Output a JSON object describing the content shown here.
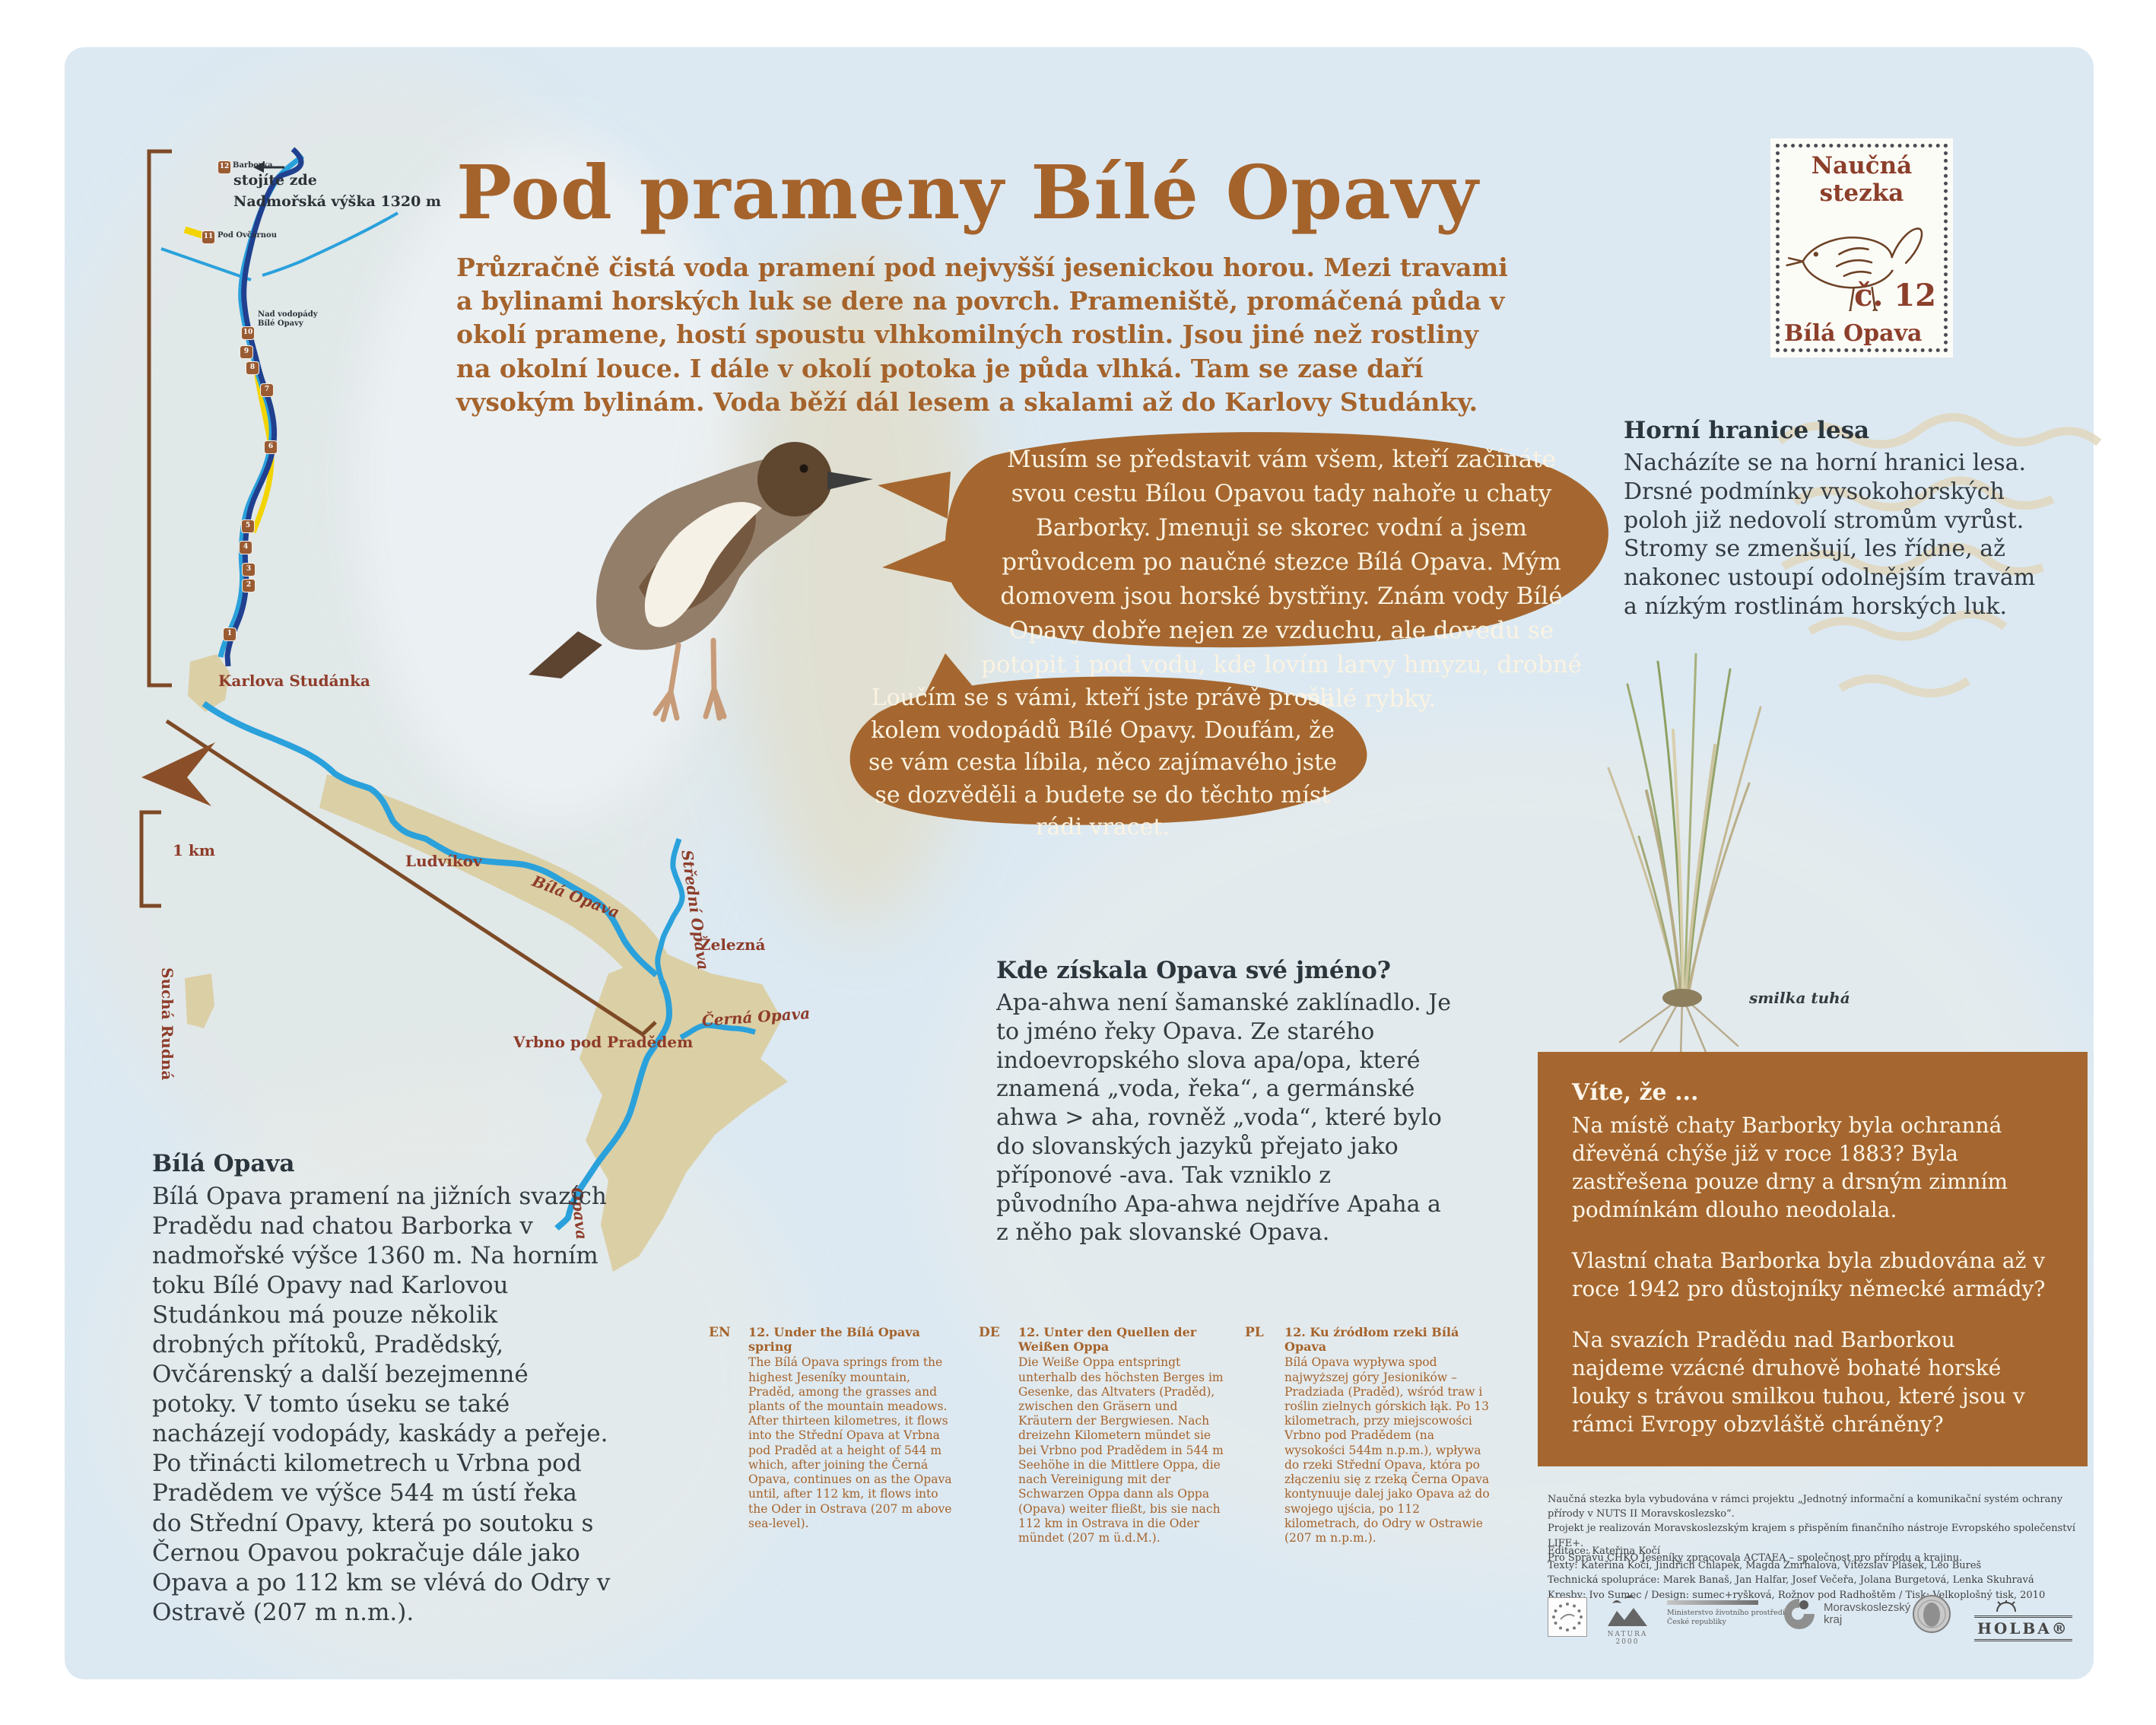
{
  "header": {
    "title": "Pod prameny Bílé Opavy",
    "intro": "Průzračně čistá voda pramení pod nejvyšší jesenickou horou. Mezi travami a bylinami horských luk se dere na povrch. Prameniště, promáčená půda v okolí pramene, hostí spoustu vlhkomilných rostlin. Jsou jiné než rostliny na okolní louce. I dále v okolí potoka je půda vlhká. Tam se zase daří vysokým bylinám. Voda běží dál lesem a skalami až do Karlovy Studánky."
  },
  "stamp": {
    "top": "Naučná stezka",
    "number": "č. 12",
    "bottom": "Bílá Opava"
  },
  "map": {
    "you_are_here": "stojíte zde",
    "altitude": "Nadmořská výška 1320 m",
    "scale": "1 km",
    "station_12": "Barborka",
    "station_11": "Pod Ovčárnou",
    "station_10": "Nad vodopády Bílé Opavy",
    "places": {
      "karlova_studanka": "Karlova Studánka",
      "ludvikov": "Ludvíkov",
      "vrbno": "Vrbno pod Pradědem",
      "zelezna": "Železná",
      "sucha_rudna": "Suchá Rudná"
    },
    "rivers": {
      "bila": "Bílá Opava",
      "stredni": "Střední Opava",
      "cerna": "Černá Opava",
      "opava": "Opava"
    },
    "markers": [
      "1",
      "2",
      "3",
      "4",
      "5",
      "6",
      "7",
      "8",
      "9",
      "10",
      "11",
      "12"
    ]
  },
  "bubbles": {
    "intro": "Musím se představit vám všem, kteří začínáte svou cestu Bílou Opavou tady nahoře u chaty Barborky. Jmenuji se skorec vodní a jsem průvodcem po naučné stezce Bílá Opava. Mým domovem jsou horské bystřiny. Znám vody Bílé Opavy dobře nejen ze vzduchu, ale dovedu se potopit i pod vodu, kde lovím larvy hmyzu, drobné korýše, plže a malé rybky.",
    "farewell": "Loučím se s vámi, kteří jste právě prošli kolem vodopádů Bílé Opavy. Doufám, že se vám cesta líbila, něco zajímavého jste se dozvěděli a budete se do těchto míst rádi vracet."
  },
  "sections": {
    "forest_line": {
      "title": "Horní hranice lesa",
      "body": "Nacházíte se na horní hranici lesa. Drsné podmínky vysokohorských poloh již nedovolí stromům vyrůst. Stromy se zmenšují, les řídne, až nakonec ustoupí odolnějším travám a nízkým rostlinám horských luk."
    },
    "name_origin": {
      "title": "Kde získala Opava své jméno?",
      "body": "Apa-ahwa není šamanské zaklínadlo. Je to jméno řeky Opava. Ze starého indoevropského slova apa/opa, které znamená „voda, řeka“, a germánské ahwa > aha, rovněž „voda“, které bylo do slovanských jazyků přejato jako příponové -ava. Tak vzniklo z původního Apa-ahwa nejdříve Apaha a z něho pak slovanské Opava."
    },
    "bila_opava": {
      "title": "Bílá Opava",
      "body": "Bílá Opava pramení na jižních svazích Pradědu nad chatou Barborka v nadmořské výšce 1360 m. Na horním toku Bílé Opavy nad Karlovou Studánkou má pouze několik drobných přítoků, Pradědský, Ovčárenský a další bezejmenné potoky. V tomto úseku se také nacházejí vodopády, kaskády a peřeje. Po třinácti kilometrech u Vrbna pod Pradědem ve výšce 544 m ústí řeka do Střední Opavy, která po soutoku s Černou Opavou pokračuje dále jako Opava a po 112 km se vlévá do Odry v Ostravě (207 m n.m.)."
    },
    "did_you_know": {
      "title": "Víte, že ...",
      "p1": "Na místě chaty Barborky byla ochranná dřevěná chýše již v roce 1883? Byla zastřešena pouze drny a drsným zimním podmínkám dlouho neodolala.",
      "p2": "Vlastní chata Barborka byla zbudována až v roce 1942 pro důstojníky německé armády?",
      "p3": "Na svazích Pradědu nad Barborkou najdeme vzácné druhově bohaté horské louky s trávou smilkou tuhou, které jsou v rámci Evropy obzvláště chráněny?"
    }
  },
  "plant": {
    "label": "smilka tuhá"
  },
  "translations": {
    "en": {
      "code": "EN",
      "title": "12. Under the Bílá Opava spring",
      "body": "The Bílá Opava springs from the highest Jeseníky mountain, Praděd, among the grasses and plants of the mountain meadows. After thirteen kilometres, it flows into the Střední Opava at Vrbna pod Praděd at a height of 544 m which, after joining the Černá Opava, continues on as the Opava until, after 112 km, it flows into the Oder in Ostrava (207 m above sea-level)."
    },
    "de": {
      "code": "DE",
      "title": "12. Unter den Quellen der Weißen Oppa",
      "body": "Die Weiße Oppa entspringt unterhalb des höchsten Berges im Gesenke, das Altvaters (Praděd), zwischen den Gräsern und Kräutern der Bergwiesen. Nach dreizehn Kilometern mündet sie bei Vrbno pod Pradědem in 544 m Seehöhe in die Mittlere Oppa, die nach Vereinigung mit der Schwarzen Oppa dann als Oppa (Opava) weiter fließt, bis sie nach 112 km in Ostrava in die Oder mündet (207 m ü.d.M.)."
    },
    "pl": {
      "code": "PL",
      "title": "12. Ku źródłom rzeki Bílá Opava",
      "body": "Bílá Opava wypływa spod najwyższej góry Jesioników – Pradziada (Praděd), wśród traw i roślin zielnych górskich łąk. Po 13 kilometrach, przy miejscowości Vrbno pod Pradědem (na wysokości 544m n.p.m.), wpływa do rzeki Střední Opava, która po złączeniu się z rzeką Černa Opava kontynuuje dalej jako Opava aż do swojego ujścia, po 112 kilometrach, do Odry w Ostrawie (207 m n.p.m.)."
    }
  },
  "credits": {
    "project_lines": [
      "Naučná stezka byla vybudována v rámci projektu „Jednotný informační a komunikační systém ochrany přírody v NUTS II Moravskoslezsko“.",
      "Projekt je realizován Moravskoslezským krajem s přispěním finančního nástroje Evropského společenství LIFE+.",
      "Pro Správu CHKO Jeseníky zpracovala ACTAEA – společnost pro přírodu a krajinu."
    ],
    "credit_lines": [
      "Editace: Kateřina Kočí",
      "Texty: Kateřina Kočí, Jindřich Chlapek, Magda Zmrhalová, Vítězslav Plášek, Leo Bureš",
      "Technická spolupráce: Marek Banaš, Jan Halfar, Josef Večeřa, Jolana Burgetová, Lenka Skuhravá",
      "Kresby: Ivo Sumec / Design: sumec+ryšková, Rožnov pod Radhoštěm / Tisk: Velkoplošný tisk, 2010"
    ]
  },
  "logos": {
    "natura": "NATURA 2000",
    "ministry_line1": "Ministerstvo životního prostředí",
    "ministry_line2": "České republiky",
    "region_line1": "Moravskoslezský",
    "region_line2": "kraj",
    "holba": "HOLBA®"
  }
}
